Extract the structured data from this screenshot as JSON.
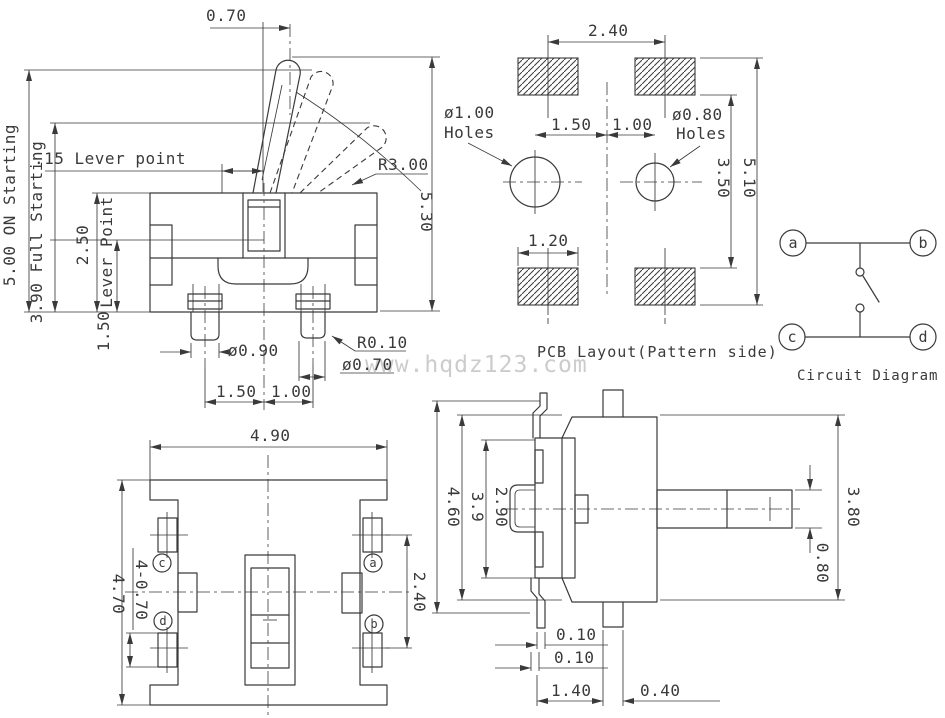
{
  "page": {
    "bg": "#ffffff",
    "line_color": "#3a3a3a",
    "watermark_color": "#cccccc",
    "watermark": "www.hqdz123.com"
  },
  "front_view": {
    "dims": {
      "tip_offset": "0.70",
      "on_starting": "5.00 ON Starting",
      "full_starting": "3.90 Full Starting",
      "lever_point_h": ".15 Lever point",
      "body_height": "2.50",
      "lever_point_label": "Lever Point",
      "lever_point_height": "1.50",
      "lever_radius": "R3.00",
      "overall_height": "5.30",
      "pin_dia_left": "ø0.90",
      "pin_tip_radius": "R0.10",
      "pin_dia_right": "ø0.70",
      "pin_pitch_left": "1.50",
      "pin_pitch_right": "1.00"
    }
  },
  "pcb_view": {
    "caption": "PCB Layout(Pattern side)",
    "dims": {
      "pad_pitch": "2.40",
      "hole_left_dia": "ø1.00",
      "hole_left_label": "Holes",
      "hole_pitch_left": "1.50",
      "hole_pitch_right": "1.00",
      "hole_right_dia": "ø0.80",
      "hole_right_label": "Holes",
      "row_span": "3.50",
      "overall_span": "5.10",
      "pad_width": "1.20"
    }
  },
  "circuit": {
    "caption": "Circuit Diagram",
    "terminals": {
      "a": "a",
      "b": "b",
      "c": "c",
      "d": "d"
    }
  },
  "bottom_view": {
    "dims": {
      "width": "4.90",
      "height": "4.70",
      "pin_size": "4-0.70",
      "pin_pitch": "2.40"
    },
    "terminals": {
      "a": "a",
      "b": "b",
      "c": "c",
      "d": "d"
    }
  },
  "side_view": {
    "dims": {
      "overall_height": "4.60",
      "body_height": "3.9",
      "housing_height": "2.90",
      "block_height": "3.80",
      "shaft_dia": "0.80",
      "gap_top": "0.10",
      "gap_bottom": "0.10",
      "pin_to_tab": "1.40",
      "tab_width": "0.40"
    }
  }
}
